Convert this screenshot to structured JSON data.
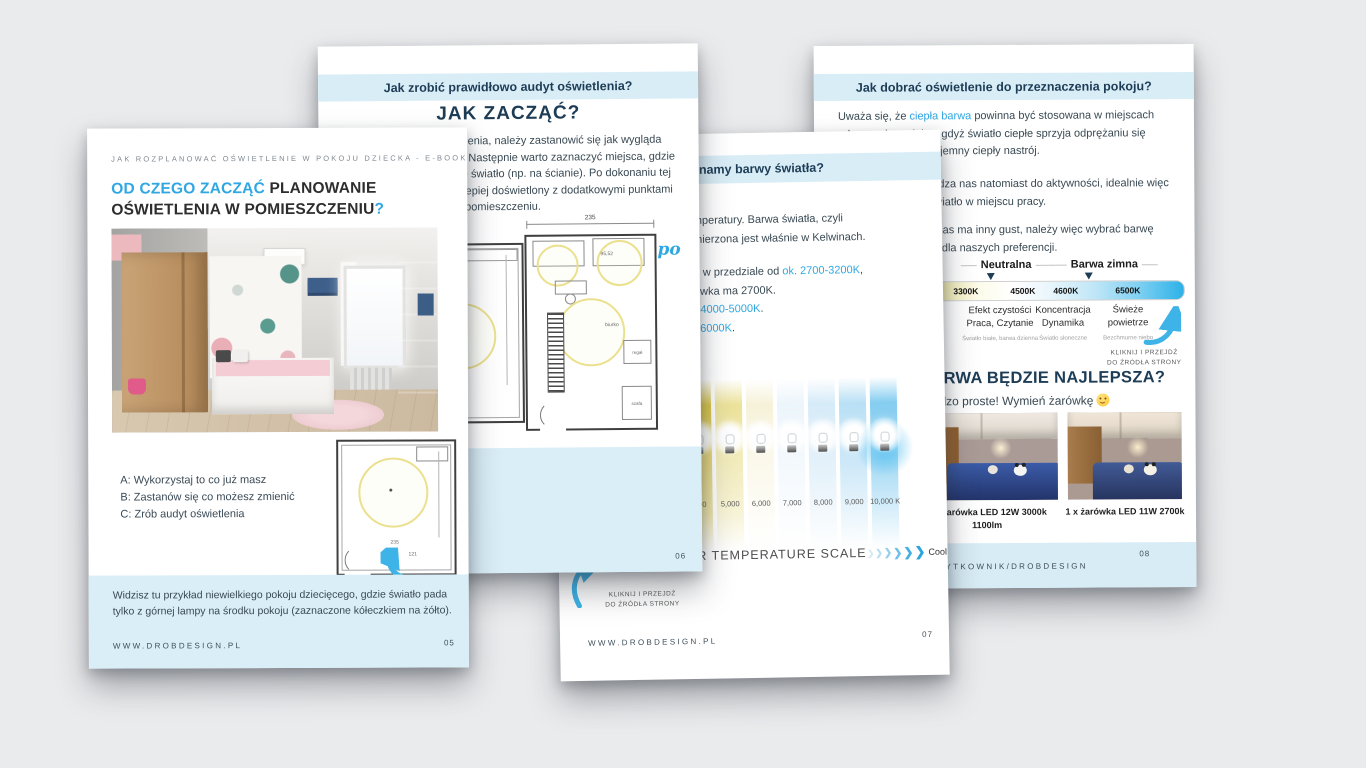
{
  "colors": {
    "background": "#eaebed",
    "accent_blue": "#2fa7e2",
    "navy": "#1d3c55",
    "band_blue": "#d9edf7",
    "box_blue": "#daeef8",
    "plan_circle_yellow": "#ebe08e",
    "arrow_blue": "#3db3e8"
  },
  "page05": {
    "page_number": "05",
    "header": "JAK ROZPLANOWAĆ OŚWIETLENIE W POKOJU DZIECKA - E-BOOK",
    "title_line1_blue": "OD CZEGO ZACZĄĆ",
    "title_line1_dark": " PLANOWANIE",
    "title_line2_dark": "OŚWIETLENIA W POMIESZCZENIU",
    "title_line2_blue": "?",
    "options": [
      "A: Wykorzystaj to co już masz",
      "B: Zastanów się co możesz zmienić",
      "C: Zrób audyt oświetlenia"
    ],
    "note_line1": "Widzisz tu przykład niewielkiego pokoju dziecięcego, gdzie światło pada",
    "note_line2": "tylko z górnej lampy na środku pokoju (zaznaczone kółeczkiem na żółto).",
    "footer": "WWW.DROBDESIGN.PL",
    "plan_dims": {
      "d1": "235",
      "d2": "121"
    }
  },
  "page06": {
    "page_number": "06",
    "band": "Jak zrobić prawidłowo audyt oświetlenia?",
    "title": "JAK ZACZĄĆ?",
    "body_fragments": [
      "ietlenia, należy zastanowić się jak wygląda",
      "ju. Następnie warto zaznaczyć miejsca, gdzie",
      "we światło (np. na ścianie). Po dokonaniu tej",
      "e lepiej doświetlony z dodatkowymi punktami",
      "w pomieszczeniu."
    ],
    "plan_dim": "235",
    "plan_labels": {
      "size": "95,52",
      "biurko": "biurko",
      "regal": "regał",
      "szafa": "szafa"
    },
    "annotation": "po"
  },
  "page07": {
    "page_number": "07",
    "band_fragment": "namy barwy światła?",
    "body": [
      {
        "pre": "mperatury. Barwa światła, czyli",
        "blue": "",
        "post": ""
      },
      {
        "pre": "mierzona jest właśnie w Kelwinach.",
        "blue": "",
        "post": ""
      },
      {
        "pre": "ę w przedziale od ",
        "blue": "ok. 2700-3200K",
        "post": ","
      },
      {
        "pre": "ówka ma 2700K.",
        "blue": "",
        "post": ""
      },
      {
        "pre": ". ",
        "blue": "4000-5000K",
        "post": "."
      },
      {
        "pre": "j ",
        "blue": "6000K",
        "post": "."
      }
    ],
    "scale_labels": [
      ",000",
      "5,000",
      "6,000",
      "7,000",
      "8,000",
      "9,000",
      "10,000 K"
    ],
    "scale_caption": "OR TEMPERATURE SCALE",
    "scale_cool": "Cool",
    "kliknij1": "KLIKNIJ I PRZEJDŹ",
    "kliknij2": "DO ŹRÓDŁA STRONY",
    "footer": "WWW.DROBDESIGN.PL"
  },
  "page08": {
    "page_number": "08",
    "band": "Jak dobrać oświetlenie do przeznaczenia pokoju?",
    "p1_pre": "Uważa się, że ",
    "p1_blue": "ciepła barwa",
    "p1_post": " powinna być stosowana w miejscach",
    "p1_l2": "odpoczynku, relaksu gdyż światło ciepłe sprzyja odprężaniu się",
    "p1_l3": "jemny ciepły nastrój.",
    "p2_l1": "dza nas natomiast do aktywności, idealnie więc",
    "p2_l2": "wiatło w miejscu pracy.",
    "p3_l1": "nas ma inny gust, należy więc wybrać barwę",
    "p3_l2": "ą dla naszych preferencji.",
    "bar": {
      "label_neutral": "Neutralna",
      "label_cold": "Barwa zimna",
      "temps": [
        "3300K",
        "4500K",
        "4600K",
        "6500K"
      ],
      "col_fragments": [
        "ra",
        "k"
      ],
      "cols": [
        [
          "Efekt czystości",
          "Praca, Czytanie"
        ],
        [
          "Koncentracja",
          "Dynamika"
        ],
        [
          "Świeże",
          "powietrze"
        ]
      ],
      "subs": [
        "Światło białe, barwa dzienna",
        "Światło słoneczne",
        "Bezchmurne niebo"
      ]
    },
    "kliknij1": "KLIKNIJ I PRZEJDŹ",
    "kliknij2": "DO ŹRÓDŁA STRONY",
    "title_fragment": "ARWA BĘDZIE NAJLEPSZA?",
    "subtitle_fragment": "rdzo proste! Wymień żarówkę",
    "caption_left1": "1 x żarówka LED 12W 3000k",
    "caption_left2": "1100lm",
    "caption_right": "1 x żarówka LED 11W 2700k",
    "footer_fragment": "ŻYTKOWNIK/DROBDESIGN"
  }
}
